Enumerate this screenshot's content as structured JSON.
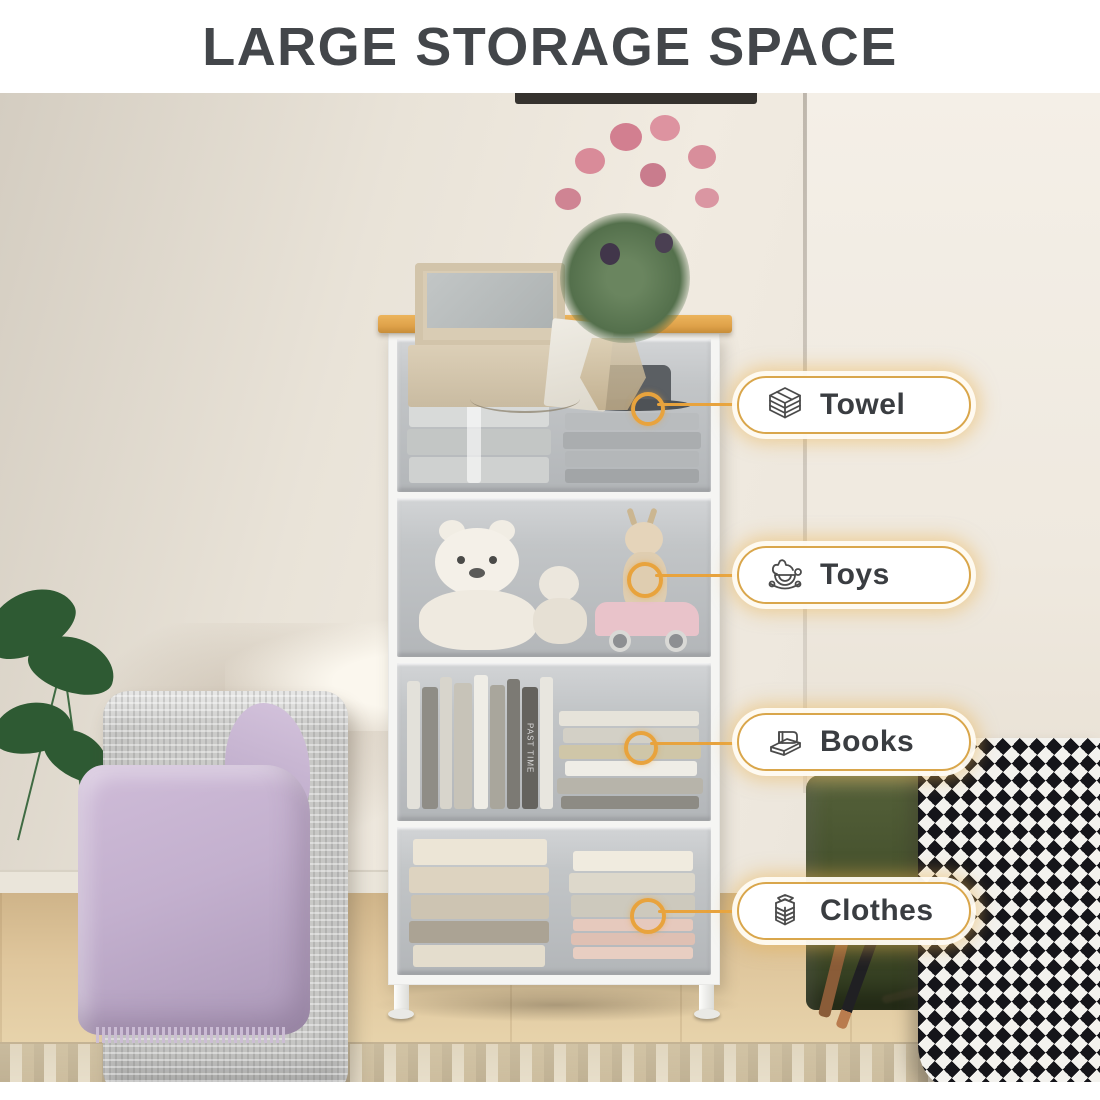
{
  "title": "LARGE STORAGE SPACE",
  "callouts": [
    {
      "label": "Towel",
      "icon": "towel-stack-icon",
      "target": "top drawer with rolled and folded towels and a hat"
    },
    {
      "label": "Toys",
      "icon": "rocking-horse-icon",
      "target": "second drawer with teddy bears, plush giraffe and pink toy car"
    },
    {
      "label": "Books",
      "icon": "books-icon",
      "target": "third drawer with vertical books and a horizontal stack"
    },
    {
      "label": "Clothes",
      "icon": "clothes-stack-icon",
      "target": "bottom drawer with folded sweaters and clothes"
    }
  ],
  "scene": {
    "book_spine_text": "PAST TIME",
    "furniture": "4-drawer fabric dresser with wood top and white metal frame",
    "decor_left": "monstera plant, woven ottoman with lavender blanket",
    "decor_right": "green velvet stool, houndstooth blanket",
    "decor_top": "mirror jewelry box, vase with pink roses"
  },
  "colors": {
    "accent_gold": "#E8A33D",
    "pill_border": "#D9A64B",
    "title_text": "#43464A",
    "wood_top": "#DFA24A",
    "drawer_fabric": "#C2C5C7",
    "stool_green": "#46522E",
    "blanket_lavender": "#C3B0CE",
    "wall_beige": "#E9E3D8"
  }
}
